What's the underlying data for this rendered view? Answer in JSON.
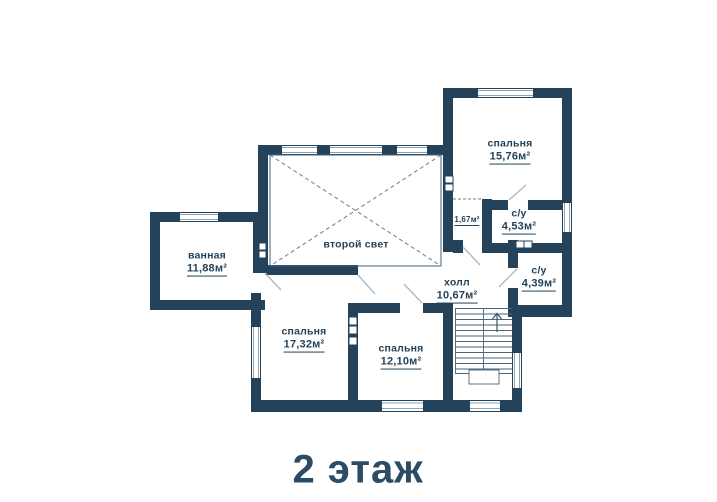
{
  "title": "2 этаж",
  "colors": {
    "wall": "#24435a",
    "text": "#24435a",
    "background": "#ffffff"
  },
  "rooms": {
    "bedroom_top": {
      "name": "спальня",
      "area": "15,76м²"
    },
    "su_top": {
      "name": "с/у",
      "area": "4,53м²"
    },
    "corridor": {
      "area": "1,67м²"
    },
    "su_mid": {
      "name": "с/у",
      "area": "4,39м²"
    },
    "bathroom": {
      "name": "ванная",
      "area": "11,88м²"
    },
    "second_light": {
      "name": "второй свет"
    },
    "hall": {
      "name": "холл",
      "area": "10,67м²"
    },
    "bedroom_left": {
      "name": "спальня",
      "area": "17,32м²"
    },
    "bedroom_mid": {
      "name": "спальня",
      "area": "12,10м²"
    }
  }
}
